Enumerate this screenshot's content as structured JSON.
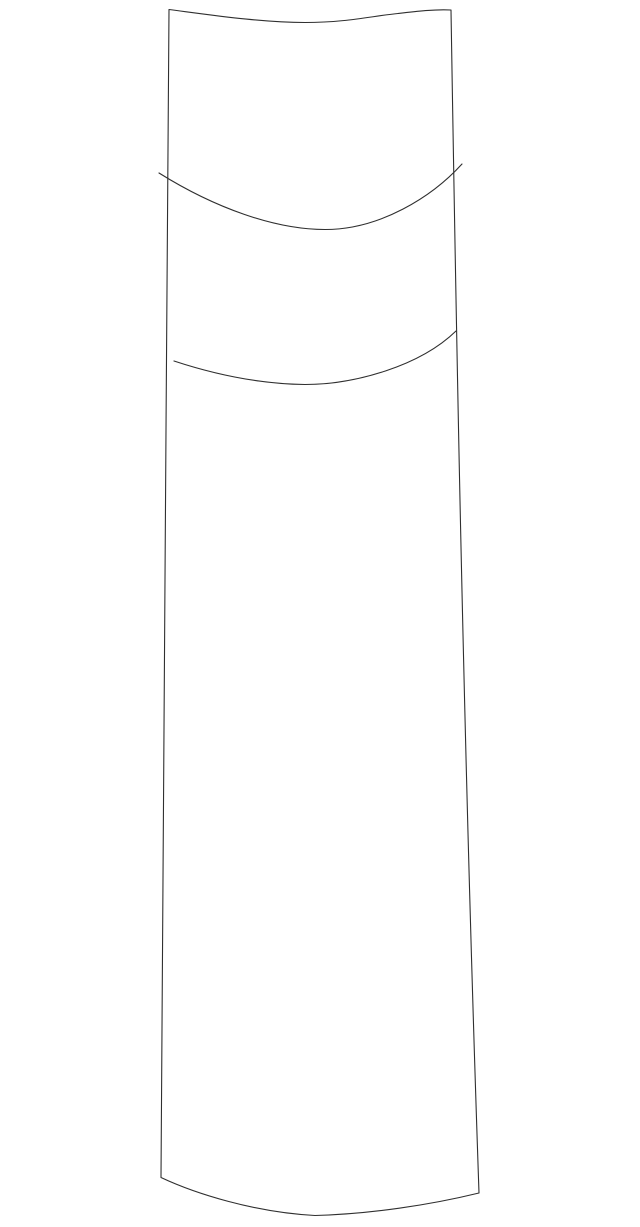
{
  "canvas": {
    "width": 640,
    "height": 1227,
    "background_color": "#ffffff"
  },
  "drawing": {
    "description": "Line sketch of a tall, slightly flaring column-like shape with a gently dipping top edge, a downward-bowed bottom edge, and two downward-curving seam lines near the top",
    "stroke_color": "#2f2f2f",
    "stroke_width": "1.1",
    "paths": {
      "outline": "M 169,9.5 C 215,15.5 262,22.5 305,22.5 C 347,22.5 372,16 398,13.5 C 415,11.5 436,9 451,10 C 455,250 462,700 479,1193 C 430,1205 370,1214 315,1215.5 C 255,1212.5 195,1193.5 161,1177.5 C 163,900 166,400 169,9.5 Z",
      "seam_upper": "M 159,173 C 215,208 275,229.5 325,229.5 C 380,229.5 432,197 462,164",
      "seam_lower": "M 174,361 C 218,375.5 262,384 305,384.5 C 355,384.5 420,366 456,331"
    }
  }
}
